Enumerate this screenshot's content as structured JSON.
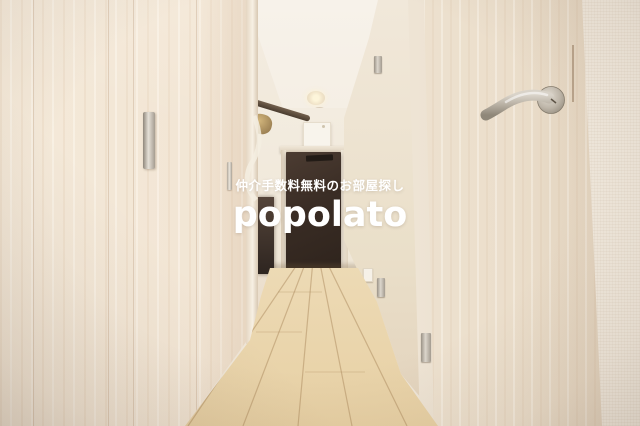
{
  "watermark": {
    "tagline": "仲介手数料無料のお部屋探し",
    "logo": "popolato",
    "text_color": "#ffffff"
  },
  "palette": {
    "ceiling": "#f5efe6",
    "wall_cream": "#f1e8db",
    "closet_wood_light": "#f2e4d2",
    "right_door_wood": "#ece0cf",
    "floor_wood": "#e9d5ac",
    "entrance_door_dark": "#3a2d26",
    "hardware_satin_chrome": "#c9c2b7"
  }
}
